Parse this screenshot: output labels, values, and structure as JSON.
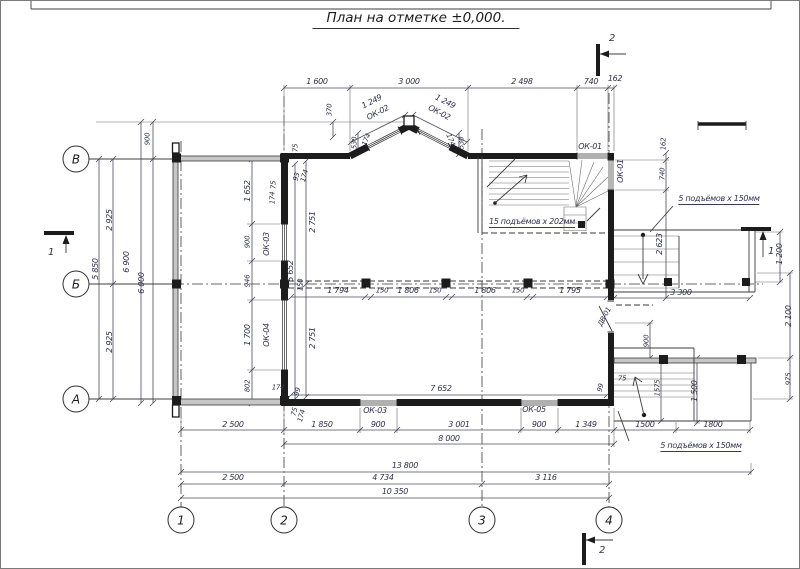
{
  "title": {
    "text": "План на отметке ±0,000."
  },
  "axes": {
    "row_bubbles": [
      {
        "label": "В",
        "x": 75,
        "y": 158
      },
      {
        "label": "Б",
        "x": 75,
        "y": 283
      },
      {
        "label": "А",
        "x": 75,
        "y": 398
      }
    ],
    "col_bubbles": [
      {
        "label": "1",
        "x": 180,
        "y": 519
      },
      {
        "label": "2",
        "x": 283,
        "y": 519
      },
      {
        "label": "3",
        "x": 481,
        "y": 519
      },
      {
        "label": "4",
        "x": 608,
        "y": 519
      }
    ]
  },
  "colors": {
    "wall": "#1c1c1c",
    "terrace": "#c6c6c6",
    "text": "#30304a",
    "bg": "#ffffff"
  },
  "labels": [
    {
      "t": "1 600",
      "x": 316,
      "y": 81
    },
    {
      "t": "3 000",
      "x": 408,
      "y": 81
    },
    {
      "t": "2 498",
      "x": 521,
      "y": 81
    },
    {
      "t": "740",
      "x": 590,
      "y": 81
    },
    {
      "t": "162",
      "x": 614,
      "y": 78
    },
    {
      "t": "370",
      "x": 329,
      "y": 109,
      "r": -90,
      "s": 7
    },
    {
      "t": "1 249",
      "x": 371,
      "y": 101,
      "r": -27
    },
    {
      "t": "ОК-02",
      "x": 377,
      "y": 112,
      "r": -27,
      "n": "window-tag-ok02-left"
    },
    {
      "t": "1 249",
      "x": 444,
      "y": 101,
      "r": 27
    },
    {
      "t": "ОК-02",
      "x": 438,
      "y": 112,
      "r": 27,
      "n": "window-tag-ok02-right"
    },
    {
      "t": "530",
      "x": 354,
      "y": 142,
      "r": -90,
      "s": 7
    },
    {
      "t": "174",
      "x": 366,
      "y": 139,
      "r": -68,
      "s": 7
    },
    {
      "t": "174",
      "x": 449,
      "y": 139,
      "r": 68,
      "s": 7
    },
    {
      "t": "530",
      "x": 461,
      "y": 142,
      "r": -90,
      "s": 7
    },
    {
      "t": "75",
      "x": 295,
      "y": 147,
      "r": -90,
      "s": 7
    },
    {
      "t": "ОК-01",
      "x": 589,
      "y": 146,
      "n": "window-tag-ok01-top"
    },
    {
      "t": "162",
      "x": 663,
      "y": 143,
      "r": -90,
      "s": 7
    },
    {
      "t": "740",
      "x": 662,
      "y": 173,
      "r": -90,
      "s": 7
    },
    {
      "t": "ОК-01",
      "x": 620,
      "y": 170,
      "r": -90,
      "n": "window-tag-ok01-right"
    },
    {
      "t": "2 623",
      "x": 659,
      "y": 243,
      "r": -90
    },
    {
      "t": "900",
      "x": 147,
      "y": 138,
      "r": -90,
      "s": 7
    },
    {
      "t": "2 925",
      "x": 109,
      "y": 219,
      "r": -90
    },
    {
      "t": "2 925",
      "x": 109,
      "y": 341,
      "r": -90
    },
    {
      "t": "5 850",
      "x": 95,
      "y": 268,
      "r": -90
    },
    {
      "t": "6 900",
      "x": 126,
      "y": 261,
      "r": -90
    },
    {
      "t": "6 000",
      "x": 141,
      "y": 282,
      "r": -90
    },
    {
      "t": "1 652",
      "x": 247,
      "y": 190,
      "r": -90
    },
    {
      "t": "900",
      "x": 247,
      "y": 241,
      "r": -90,
      "s": 7
    },
    {
      "t": "946",
      "x": 247,
      "y": 280,
      "r": -90,
      "s": 7
    },
    {
      "t": "1 700",
      "x": 247,
      "y": 334,
      "r": -90
    },
    {
      "t": "802",
      "x": 247,
      "y": 385,
      "r": -90,
      "s": 7
    },
    {
      "t": "ОК-03",
      "x": 266,
      "y": 243,
      "r": -90,
      "n": "window-tag-ok03-left"
    },
    {
      "t": "ОК-04",
      "x": 266,
      "y": 334,
      "r": -90,
      "n": "window-tag-ok04"
    },
    {
      "t": "75",
      "x": 273,
      "y": 184,
      "r": -90,
      "s": 7
    },
    {
      "t": "174",
      "x": 272,
      "y": 197,
      "r": -90,
      "s": 7
    },
    {
      "t": "93",
      "x": 296,
      "y": 176,
      "r": -75,
      "s": 7
    },
    {
      "t": "174",
      "x": 304,
      "y": 175,
      "r": -75,
      "s": 7
    },
    {
      "t": "2 751",
      "x": 312,
      "y": 221,
      "r": -90
    },
    {
      "t": "5 652",
      "x": 290,
      "y": 270,
      "r": -90
    },
    {
      "t": "2 751",
      "x": 312,
      "y": 337,
      "r": -90
    },
    {
      "t": "150",
      "x": 300,
      "y": 284,
      "r": -90,
      "s": 7
    },
    {
      "t": "1 794",
      "x": 337,
      "y": 290
    },
    {
      "t": "150",
      "x": 381,
      "y": 290,
      "s": 7
    },
    {
      "t": "1 806",
      "x": 407,
      "y": 290
    },
    {
      "t": "150",
      "x": 434,
      "y": 290,
      "s": 7
    },
    {
      "t": "1 806",
      "x": 484,
      "y": 290
    },
    {
      "t": "150",
      "x": 517,
      "y": 290,
      "s": 7
    },
    {
      "t": "1 795",
      "x": 569,
      "y": 290
    },
    {
      "t": "7 652",
      "x": 440,
      "y": 388
    },
    {
      "t": "174",
      "x": 277,
      "y": 387,
      "s": 7
    },
    {
      "t": "99",
      "x": 297,
      "y": 391,
      "r": -75,
      "s": 7
    },
    {
      "t": "75",
      "x": 294,
      "y": 411,
      "r": -75,
      "s": 7
    },
    {
      "t": "174",
      "x": 301,
      "y": 415,
      "r": -75,
      "s": 7
    },
    {
      "t": "ОК-03",
      "x": 374,
      "y": 410,
      "n": "window-tag-ok03-bottom"
    },
    {
      "t": "ОК-05",
      "x": 533,
      "y": 409,
      "n": "window-tag-ok05"
    },
    {
      "t": "99",
      "x": 600,
      "y": 387,
      "r": -75,
      "s": 7
    },
    {
      "t": "75",
      "x": 621,
      "y": 378,
      "s": 7
    },
    {
      "t": "1575",
      "x": 657,
      "y": 387,
      "r": -90,
      "s": 7
    },
    {
      "t": "2 500",
      "x": 232,
      "y": 424
    },
    {
      "t": "1 850",
      "x": 321,
      "y": 424
    },
    {
      "t": "900",
      "x": 377,
      "y": 424
    },
    {
      "t": "3 001",
      "x": 458,
      "y": 424
    },
    {
      "t": "900",
      "x": 538,
      "y": 424
    },
    {
      "t": "1 349",
      "x": 585,
      "y": 424
    },
    {
      "t": "1500",
      "x": 644,
      "y": 424
    },
    {
      "t": "1800",
      "x": 712,
      "y": 424
    },
    {
      "t": "8 000",
      "x": 448,
      "y": 438
    },
    {
      "t": "13 800",
      "x": 404,
      "y": 465
    },
    {
      "t": "2 500",
      "x": 232,
      "y": 477
    },
    {
      "t": "4 734",
      "x": 382,
      "y": 477
    },
    {
      "t": "3 116",
      "x": 545,
      "y": 477
    },
    {
      "t": "10 350",
      "x": 394,
      "y": 491
    },
    {
      "t": "5 подъёмов x 150мм",
      "x": 718,
      "y": 199,
      "u": 1,
      "n": "note-porch-steps-right"
    },
    {
      "t": "3 300",
      "x": 680,
      "y": 292
    },
    {
      "t": "1 200",
      "x": 779,
      "y": 253,
      "r": -90
    },
    {
      "t": "1",
      "x": 770,
      "y": 251,
      "s": 10,
      "n": "section-mark-1-right-label"
    },
    {
      "t": "2 100",
      "x": 788,
      "y": 315,
      "r": -90
    },
    {
      "t": "975",
      "x": 788,
      "y": 378,
      "r": -90,
      "s": 7
    },
    {
      "t": "900",
      "x": 646,
      "y": 340,
      "r": -90,
      "s": 7
    },
    {
      "t": "1 500",
      "x": 694,
      "y": 390,
      "r": -90
    },
    {
      "t": "ДВ-01",
      "x": 604,
      "y": 316,
      "r": -62,
      "s": 7,
      "n": "door-tag-dv01"
    },
    {
      "t": "5 подъёмов x 150мм",
      "x": 700,
      "y": 446,
      "u": 1,
      "n": "note-porch-steps-bottom"
    },
    {
      "t": "15 подъёмов x 202мм",
      "x": 531,
      "y": 222,
      "u": 1,
      "n": "note-stairs"
    },
    {
      "t": "2",
      "x": 611,
      "y": 38,
      "s": 10,
      "n": "section-mark-2-top-label"
    },
    {
      "t": "2",
      "x": 601,
      "y": 550,
      "s": 10,
      "n": "section-mark-2-bottom-label"
    },
    {
      "t": "1",
      "x": 50,
      "y": 252,
      "s": 10,
      "n": "section-mark-1-left-label"
    }
  ]
}
